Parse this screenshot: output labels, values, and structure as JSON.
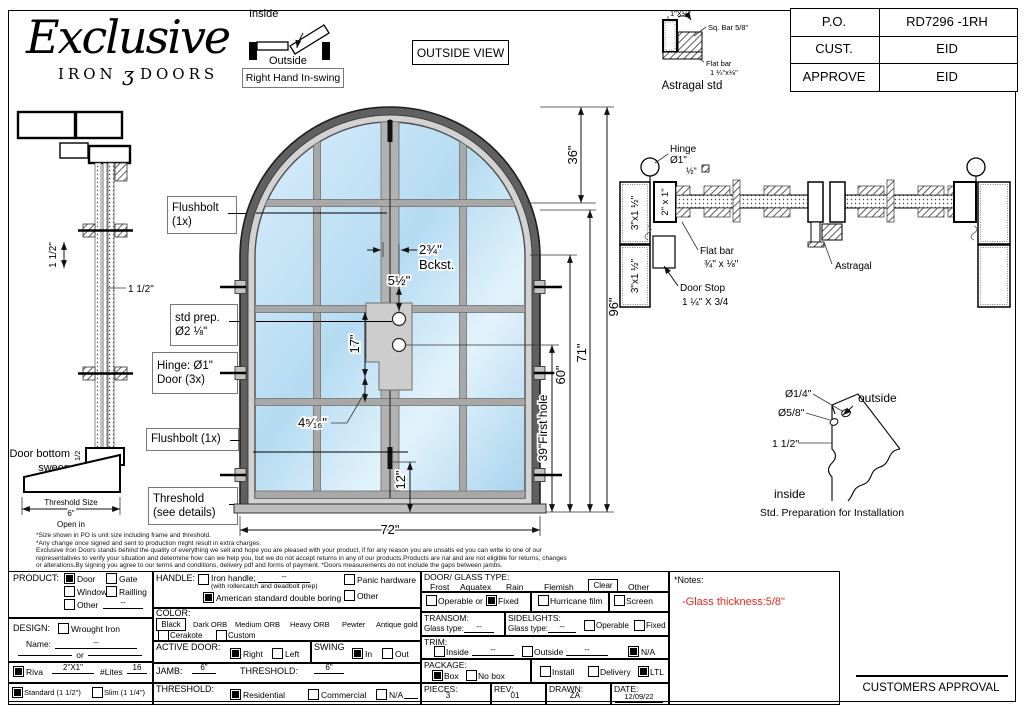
{
  "logo": {
    "script": "Exclusive",
    "word1": "IRON",
    "flourish": "ʒ",
    "word2": "DOORS"
  },
  "top": {
    "inside": "Inside",
    "outside": "Outside",
    "swing": "Right Hand In-swing",
    "view": "OUTSIDE VIEW"
  },
  "po": {
    "rows": [
      {
        "label": "P.O.",
        "value": "RD7296 -1RH"
      },
      {
        "label": "CUST.",
        "value": "EID"
      },
      {
        "label": "APPROVE",
        "value": "EID"
      }
    ]
  },
  "astragal": {
    "dim": "1\"X½\"",
    "sq": "Sq. Bar 5/8\"",
    "flat1": "Flat bar",
    "flat2": "1 ¼\"x⅛\"",
    "caption": "Astragal std"
  },
  "leftsec": {
    "v15": "1 1/2\"",
    "h15": "1 1/2\"",
    "sweep1": "Door bottom",
    "sweep2": "sweep",
    "half": "1/2",
    "ts1": "Threshold Size",
    "ts2": "6\"",
    "ts3": "Open in"
  },
  "callouts": {
    "fb1a": "Flushbolt",
    "fb1b": "(1x)",
    "sp1": "std prep.",
    "sp2": "Ø2 ⅛\"",
    "hg1": "Hinge: Ø1\"",
    "hg2": "Door (3x)",
    "fb2": "Flushbolt (1x)",
    "th1": "Threshold",
    "th2": "(see details)"
  },
  "dims": {
    "d36": "36\"",
    "d96": "96\"",
    "d71": "71\"",
    "d60": "60\"",
    "d39": "39\"First hole",
    "d12": "12\"",
    "d72": "72\"",
    "d17": "17\"",
    "bck1": "2¾\"",
    "bck2": "Bckst.",
    "d55": "5½\"",
    "d4516": "4⁵⁄₁₆\""
  },
  "plan": {
    "hinge1": "Hinge",
    "hinge2": "Ø1\"",
    "halfsq": "½\"",
    "jamb21": "2\" x 1\"",
    "jamb315a": "3\"x1 ½\"",
    "jamb315b": "3\"x1 ½\"",
    "flat1": "Flat bar",
    "flat2": "¾\" x ⅛\"",
    "stop1": "Door Stop",
    "stop2": "1 ¼\" X 3/4",
    "astragal": "Astragal"
  },
  "stdprep": {
    "d14": "Ø1/4\"",
    "d58": "Ø5/8\"",
    "d112": "1 1/2\"",
    "outside": "outside",
    "inside": "inside",
    "caption": "Std. Preparation for Installation"
  },
  "disclaimer": {
    "l1": "*Size shown in PO is unit size including frame and threshold.",
    "l2": "*Any change once signed and sent to production might result in extra charges.",
    "l3": "Exclusive Iron Doors stands behind the quality of everything we sell and hope you are pleased with your product, if for any reason you are unsatis ed you can write to one of our",
    "l4": "representatives to verify your situation and determine how can we help you, but we do not accept returns in any of our products.Products are nal and are not eligible for returns, changes",
    "l5": "or alterations.By signing you agree to our terms and conditions, delivery pdf and forms of payment. *Doors measurements do not include the gaps between jambs."
  },
  "form": {
    "product": {
      "label": "PRODUCT:",
      "door": {
        "label": "Door",
        "checked": true
      },
      "gate": {
        "label": "Gate",
        "checked": false
      },
      "window": {
        "label": "Window",
        "checked": false
      },
      "railling": {
        "label": "Railling",
        "checked": false
      },
      "other": {
        "label": "Other",
        "checked": false
      },
      "other_value": "--"
    },
    "design": {
      "label": "DESIGN:",
      "wrought": {
        "label": "Wrought Iron",
        "checked": false
      },
      "name_label": "Name:",
      "name_value": "--",
      "or": "or"
    },
    "riva": {
      "checked": true,
      "label": "Riva",
      "size": "2\"X1\"",
      "lites_label": "#Lites",
      "lites_value": "16"
    },
    "frame": {
      "standard": {
        "label": "Standard (1 1/2\")",
        "checked": true
      },
      "slim": {
        "label": "Slim (1 1/4\")",
        "checked": false
      }
    },
    "handle": {
      "label": "HANDLE:",
      "iron": {
        "label": "Iron handle;",
        "value": "--",
        "sub": "(with rollercatch and deadbolt prep)",
        "checked": false
      },
      "american": {
        "label": "American standard double boring",
        "checked": true
      },
      "panic": {
        "label": "Panic hardware",
        "checked": false
      },
      "other": {
        "label": "Other",
        "checked": false
      }
    },
    "color": {
      "label": "COLOR:",
      "selected": "Black",
      "opts": [
        "Dark ORB",
        "Medium ORB",
        "Heavy ORB",
        "Pewter",
        "Antique gold"
      ],
      "cerakote": {
        "label": "Cerakote",
        "checked": false
      },
      "custom": {
        "label": "Custom",
        "checked": false
      }
    },
    "active": {
      "label": "ACTIVE DOOR:",
      "right": {
        "label": "Right",
        "checked": true
      },
      "left": {
        "label": "Left",
        "checked": false
      }
    },
    "swing": {
      "label": "SWING",
      "in": {
        "label": "In",
        "checked": true
      },
      "out": {
        "label": "Out",
        "checked": false
      }
    },
    "jamb": {
      "label": "JAMB:",
      "value": "6\"",
      "t_label": "THRESHOLD:",
      "t_value": "6\""
    },
    "threshold": {
      "label": "THRESHOLD:",
      "residential": {
        "label": "Residential",
        "checked": true
      },
      "commercial": {
        "label": "Commercial",
        "checked": false
      },
      "na": {
        "label": "N/A",
        "checked": false
      }
    },
    "glass": {
      "label": "DOOR/ GLASS TYPE:",
      "frost": "Frost",
      "aquatex": "Aquatex",
      "rain": "Rain",
      "flemish": "Flemish",
      "clear": "Clear",
      "other": "Other"
    },
    "glassopts": {
      "operable": {
        "label": "Operable  or",
        "checked": false
      },
      "fixed": {
        "label": "Fixed",
        "checked": true
      },
      "hurricane": {
        "label": "Hurricane film",
        "checked": false
      },
      "screen": {
        "label": "Screen",
        "checked": false
      }
    },
    "transom": {
      "label": "TRANSOM:",
      "glass_label": "Glass type:",
      "value": "--"
    },
    "sidelights": {
      "label": "SIDELIGHTS:",
      "glass_label": "Glass type:",
      "value": "--",
      "operable": {
        "label": "Operable",
        "checked": false
      },
      "fixed": {
        "label": "Fixed",
        "checked": false
      }
    },
    "trim": {
      "label": "TRIM:",
      "inside": {
        "label": "Inside",
        "checked": false,
        "value": "--"
      },
      "outside": {
        "label": "Outside",
        "checked": false,
        "value": "--"
      },
      "na": {
        "label": "N/A",
        "checked": true
      }
    },
    "package": {
      "label": "PACKAGE:",
      "box": {
        "label": "Box",
        "checked": true
      },
      "nobox": {
        "label": "No box",
        "checked": false
      },
      "install": {
        "label": "Install",
        "checked": false
      },
      "delivery": {
        "label": "Delivery",
        "checked": false
      },
      "ltl": {
        "label": "LTL",
        "checked": true
      }
    },
    "meta": {
      "pieces_label": "PIECES:",
      "pieces": "3",
      "rev_label": "REV:",
      "rev": "01",
      "drawn_label": "DRAWN:",
      "drawn": "ZA",
      "date_label": "DATE:",
      "date": "12/09/22"
    }
  },
  "notes": {
    "title": "*Notes:",
    "n1": "-Glass thickness:5/8\"",
    "color": "#e8291f"
  },
  "approval": {
    "label": "CUSTOMERS APPROVAL"
  }
}
